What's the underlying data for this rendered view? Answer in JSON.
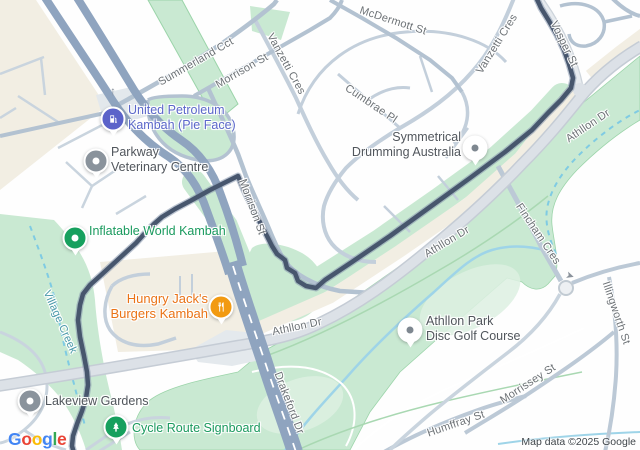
{
  "colors": {
    "route": "#47566d",
    "highway": "#8fa4bf",
    "green_area": "#c9e9d2",
    "beige_area": "#f2eee3",
    "creek": "#7fcbe3",
    "poi_green": "#17a05e",
    "poi_orange": "#f29a11",
    "poi_indigo": "#5b63c9",
    "poi_gray": "#8a939c"
  },
  "streets": {
    "summerland": "Summerland Cct",
    "morrison_top": "Morrison St",
    "mcdermott": "McDermott St",
    "vanzetti_a": "Vanzetti Cres",
    "vanzetti_b": "Vanzetti Cres",
    "vosper": "Vosper St",
    "cumbrae": "Cumbrae Pl",
    "morrison_side": "Morrison St",
    "athllon_a": "Athllon Dr",
    "athllon_b": "Athllon Dr",
    "athllon_c": "Athllon Dr",
    "drakeford": "Drakeford Dr",
    "fincham": "Fincham Cres",
    "illingworth": "Illingworth St",
    "morrissey": "Morrissey St",
    "humffray": "Humffray St"
  },
  "water": {
    "village_creek": "Village Creek"
  },
  "pois": {
    "united": {
      "line1": "United Petroleum",
      "line2": "Kambah (Pie Face)"
    },
    "parkway": {
      "line1": "Parkway",
      "line2": "Veterinary Centre"
    },
    "inflatable": {
      "line1": "Inflatable World Kambah"
    },
    "hungry": {
      "line1": "Hungry Jack's",
      "line2": "Burgers Kambah"
    },
    "symmetrical": {
      "line1": "Symmetrical",
      "line2": "Drumming Australia"
    },
    "disc_golf": {
      "line1": "Athllon Park",
      "line2": "Disc Golf Course"
    },
    "lakeview": {
      "line1": "Lakeview Gardens"
    },
    "cycle": {
      "line1": "Cycle Route Signboard"
    }
  },
  "icons": {
    "one_way_up": "↑",
    "one_way_right": "➤"
  },
  "branding": {
    "google_letters": [
      "G",
      "o",
      "o",
      "g",
      "l",
      "e"
    ],
    "attribution": "Map data ©2025 Google"
  }
}
